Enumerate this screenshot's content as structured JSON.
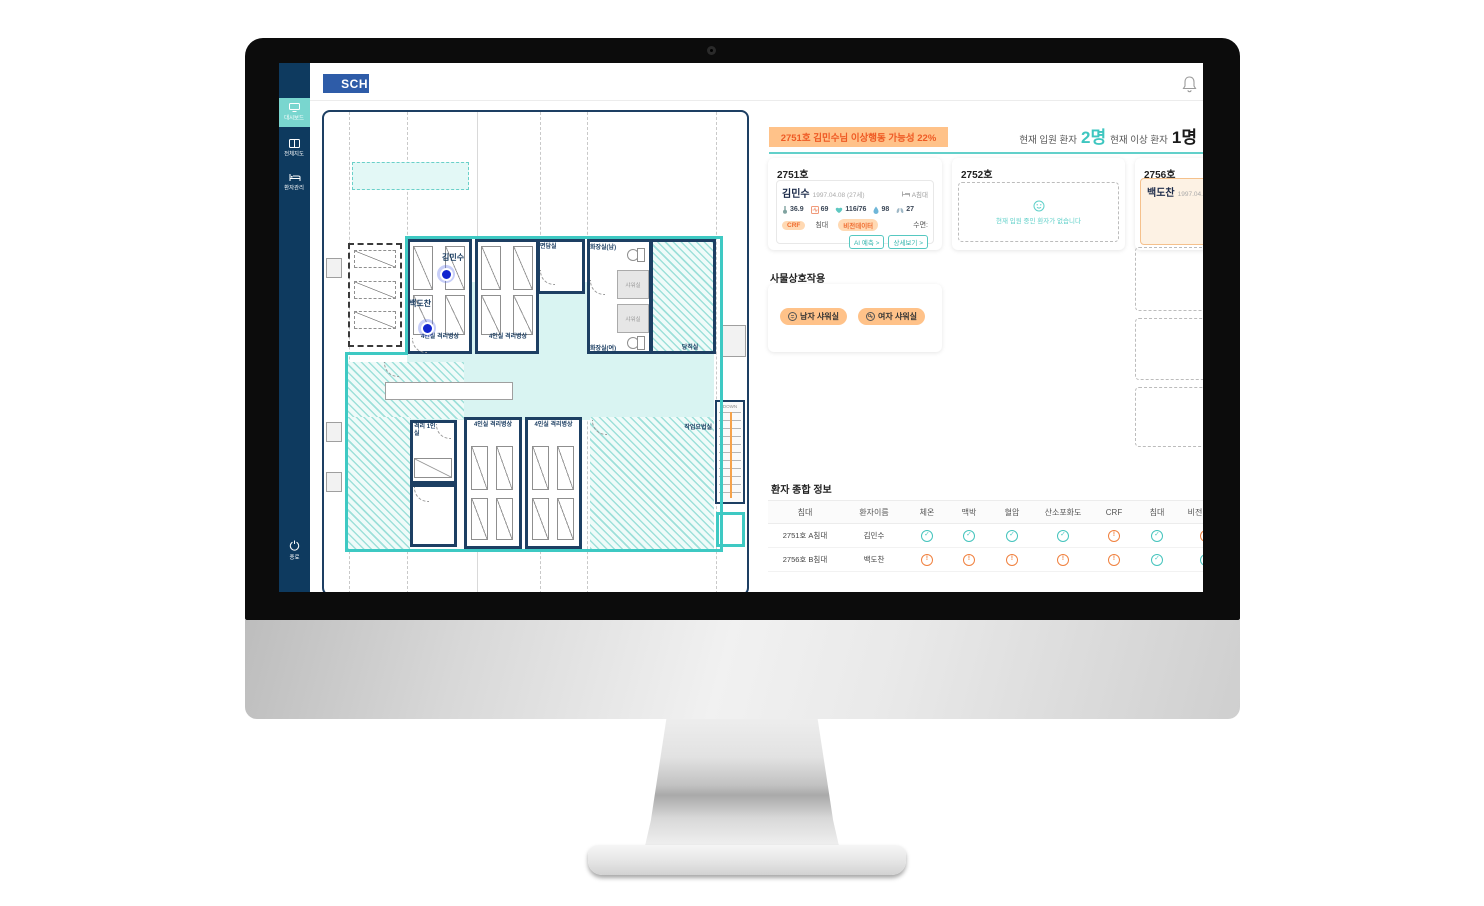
{
  "header": {
    "logo_text": "SCH"
  },
  "sidebar": {
    "items": [
      {
        "label": "대시보드"
      },
      {
        "label": "전체지도"
      },
      {
        "label": "환자관리"
      }
    ],
    "exit_label": "종료"
  },
  "alert_banner": {
    "text": "2751호 김민수님 이상행동 가능성 22%"
  },
  "stats": {
    "admitted_label": "현재 입원 환자",
    "admitted_value": "2명",
    "abnormal_label": "현재 이상 환자",
    "abnormal_value": "1명"
  },
  "room_cards": {
    "room1": {
      "title": "2751호",
      "name": "김민수",
      "birth": "1997.04.08 (27세)",
      "bed": "A침대",
      "vitals": {
        "temperature": "36.9",
        "pulse": "69",
        "blood_pressure": "116/76",
        "spo2": "98",
        "respiration": "27"
      },
      "tags": {
        "crf": "CRF",
        "bed": "침대",
        "vision": "비전데이터",
        "sleep": "수면:"
      },
      "buttons": {
        "ai": "AI 예측 >",
        "detail": "상세보기 >"
      }
    },
    "room2": {
      "title": "2752호",
      "empty_text": "현재 입원 중인 환자가 없습니다"
    },
    "room3": {
      "title": "2756호",
      "name": "백도찬",
      "birth": "1997.04.08 (",
      "alert_number": "2"
    }
  },
  "interaction": {
    "title": "사물상호작용",
    "buttons": [
      {
        "label": "남자 샤워실"
      },
      {
        "label": "여자 샤워실"
      }
    ]
  },
  "patient_table": {
    "title": "환자 종합 정보",
    "headers": [
      "침대",
      "환자이름",
      "체온",
      "맥박",
      "혈압",
      "산소포화도",
      "CRF",
      "침대",
      "비전데이터"
    ],
    "rows": [
      {
        "bed": "2751호 A침대",
        "name": "김민수",
        "status": [
          "ok",
          "ok",
          "ok",
          "ok",
          "warn",
          "ok",
          "warn"
        ]
      },
      {
        "bed": "2756호 B침대",
        "name": "백도찬",
        "status": [
          "warn",
          "warn",
          "warn",
          "warn",
          "warn",
          "ok",
          "ok"
        ]
      }
    ]
  },
  "map": {
    "patients": [
      {
        "name": "김민수"
      },
      {
        "name": "백도찬"
      }
    ],
    "labels": {
      "ward4": "4인실 격리병상",
      "consult": "면담실",
      "toilet_m": "화장실(남)",
      "shower": "샤워실",
      "toilet_f": "화장실(여)",
      "duty": "당직실",
      "iso1": "격리 1인실",
      "therapy": "작업요법실",
      "down": "DOWN"
    }
  },
  "colors": {
    "accent_teal": "#3ec9c3",
    "accent_orange": "#ef5a24",
    "navy": "#16395e",
    "sidebar": "#0e3a5f"
  }
}
